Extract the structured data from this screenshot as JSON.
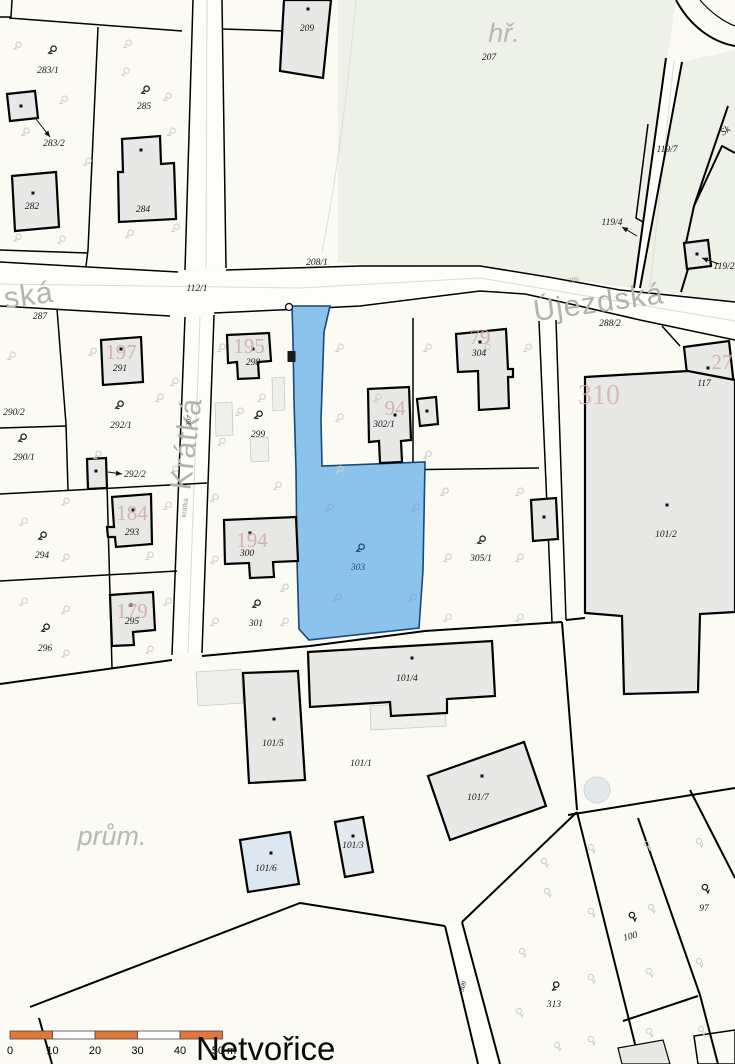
{
  "title": "Netvořice",
  "title_pos": [
    196,
    1060
  ],
  "colors": {
    "paper": "#fbfbf4",
    "field_green": "#edf1e6",
    "water_blue": "#8cc3ec",
    "water_border": "#17497c",
    "building_fill": "#e8e8e6",
    "building_number_pink": "#d2a7a7",
    "street_gray": "#b3b3ae",
    "scale_orange": "#e2763b"
  },
  "map": {
    "labels": [
      {
        "text": "283/1",
        "x": 48,
        "y": 73,
        "cls": "p",
        "name": "parcel-label-283-1"
      },
      {
        "text": "285",
        "x": 144,
        "y": 109,
        "cls": "p",
        "name": "parcel-label-285"
      },
      {
        "text": "283/2",
        "x": 54,
        "y": 146,
        "cls": "p",
        "name": "parcel-label-283-2"
      },
      {
        "text": "282",
        "x": 32,
        "y": 209,
        "cls": "p",
        "name": "parcel-label-282"
      },
      {
        "text": "284",
        "x": 143,
        "y": 212,
        "cls": "p",
        "name": "parcel-label-284"
      },
      {
        "text": "209",
        "x": 307,
        "y": 31,
        "cls": "p",
        "name": "parcel-label-209"
      },
      {
        "text": "hř.",
        "x": 504,
        "y": 42,
        "cls": "area",
        "name": "area-label-hriste"
      },
      {
        "text": "207",
        "x": 489,
        "y": 60,
        "cls": "p",
        "name": "parcel-label-207"
      },
      {
        "text": "119/7",
        "x": 667,
        "y": 152,
        "cls": "p",
        "name": "parcel-label-119-7"
      },
      {
        "text": "Sk",
        "x": 727,
        "y": 133,
        "cls": "sk",
        "rot": -35,
        "name": "label-sk"
      },
      {
        "text": "119/4",
        "x": 612,
        "y": 225,
        "cls": "p",
        "name": "parcel-label-119-4"
      },
      {
        "text": "119/2",
        "x": 724,
        "y": 269,
        "cls": "p",
        "name": "parcel-label-119-2"
      },
      {
        "text": "208/1",
        "x": 317,
        "y": 265,
        "cls": "p",
        "name": "parcel-label-208-1"
      },
      {
        "text": "112/1",
        "x": 197,
        "y": 291,
        "cls": "p",
        "name": "parcel-label-112-1"
      },
      {
        "text": "ská",
        "x": 30,
        "y": 305,
        "cls": "street",
        "rot": -8,
        "name": "street-label-ska"
      },
      {
        "text": "287",
        "x": 40,
        "y": 319,
        "cls": "p",
        "name": "parcel-label-287"
      },
      {
        "text": "Újezdská",
        "x": 600,
        "y": 312,
        "cls": "street",
        "rot": -8,
        "name": "street-label-ujezdska"
      },
      {
        "text": "288/2",
        "x": 610,
        "y": 326,
        "cls": "p",
        "name": "parcel-label-288-2"
      },
      {
        "text": "288",
        "x": 574,
        "y": 282,
        "cls": "pink-tiny",
        "rot": -12,
        "name": "parcel-label-288"
      },
      {
        "text": "197",
        "x": 121,
        "y": 359,
        "cls": "bnum",
        "name": "building-number-197"
      },
      {
        "text": "291",
        "x": 120,
        "y": 371,
        "cls": "p",
        "name": "parcel-label-291"
      },
      {
        "text": "292/1",
        "x": 121,
        "y": 428,
        "cls": "p",
        "name": "parcel-label-292-1"
      },
      {
        "text": "290/2",
        "x": 14,
        "y": 415,
        "cls": "p",
        "name": "parcel-label-290-2"
      },
      {
        "text": "290/1",
        "x": 24,
        "y": 460,
        "cls": "p",
        "name": "parcel-label-290-1"
      },
      {
        "text": "292/2",
        "x": 135,
        "y": 477,
        "cls": "p",
        "name": "parcel-label-292-2"
      },
      {
        "text": "Krátká",
        "x": 196,
        "y": 445,
        "cls": "street",
        "rot": -83,
        "name": "street-label-kratka"
      },
      {
        "text": "307",
        "x": 191,
        "y": 421,
        "cls": "tiny",
        "rot": -82,
        "name": "parcel-label-307"
      },
      {
        "text": "krátká",
        "x": 187,
        "y": 508,
        "cls": "streettiny",
        "rot": -82,
        "name": "street-label-kratka-small"
      },
      {
        "text": "195",
        "x": 249,
        "y": 353,
        "cls": "bnum",
        "name": "building-number-195"
      },
      {
        "text": "298",
        "x": 253,
        "y": 365,
        "cls": "p",
        "name": "parcel-label-298"
      },
      {
        "text": "299",
        "x": 258,
        "y": 437,
        "cls": "p",
        "name": "parcel-label-299"
      },
      {
        "text": "303",
        "x": 358,
        "y": 570,
        "cls": "blue",
        "name": "parcel-label-303"
      },
      {
        "text": "94",
        "x": 395,
        "y": 415,
        "cls": "bnum",
        "name": "building-number-94"
      },
      {
        "text": "302/1",
        "x": 384,
        "y": 427,
        "cls": "p",
        "name": "parcel-label-302-1"
      },
      {
        "text": "79",
        "x": 480,
        "y": 344,
        "cls": "bnum",
        "name": "building-number-79"
      },
      {
        "text": "304",
        "x": 479,
        "y": 356,
        "cls": "p",
        "name": "parcel-label-304"
      },
      {
        "text": "310",
        "x": 599,
        "y": 404,
        "cls": "bnumlg",
        "name": "building-number-310"
      },
      {
        "text": "27",
        "x": 722,
        "y": 369,
        "cls": "bnum",
        "name": "building-number-27"
      },
      {
        "text": "117",
        "x": 704,
        "y": 386,
        "cls": "p",
        "name": "parcel-label-117"
      },
      {
        "text": "101/2",
        "x": 666,
        "y": 537,
        "cls": "p",
        "name": "parcel-label-101-2"
      },
      {
        "text": "194",
        "x": 252,
        "y": 547,
        "cls": "bnum",
        "name": "building-number-194"
      },
      {
        "text": "300",
        "x": 247,
        "y": 556,
        "cls": "p",
        "name": "parcel-label-300"
      },
      {
        "text": "301",
        "x": 256,
        "y": 626,
        "cls": "p",
        "name": "parcel-label-301"
      },
      {
        "text": "305/1",
        "x": 481,
        "y": 561,
        "cls": "p",
        "name": "parcel-label-305-1"
      },
      {
        "text": "184",
        "x": 132,
        "y": 520,
        "cls": "bnum",
        "name": "building-number-184"
      },
      {
        "text": "293",
        "x": 132,
        "y": 535,
        "cls": "p",
        "name": "parcel-label-293"
      },
      {
        "text": "294",
        "x": 42,
        "y": 558,
        "cls": "p",
        "name": "parcel-label-294"
      },
      {
        "text": "179",
        "x": 132,
        "y": 618,
        "cls": "bnum",
        "name": "building-number-179"
      },
      {
        "text": "295",
        "x": 132,
        "y": 624,
        "cls": "p",
        "name": "parcel-label-295"
      },
      {
        "text": "296",
        "x": 45,
        "y": 651,
        "cls": "p",
        "name": "parcel-label-296"
      },
      {
        "text": "101/4",
        "x": 407,
        "y": 681,
        "cls": "p",
        "name": "parcel-label-101-4"
      },
      {
        "text": "101/5",
        "x": 273,
        "y": 746,
        "cls": "p",
        "name": "parcel-label-101-5"
      },
      {
        "text": "101/1",
        "x": 361,
        "y": 766,
        "cls": "p",
        "name": "parcel-label-101-1"
      },
      {
        "text": "101/7",
        "x": 478,
        "y": 800,
        "cls": "p",
        "name": "parcel-label-101-7"
      },
      {
        "text": "prům.",
        "x": 112,
        "y": 845,
        "cls": "area",
        "name": "area-label-prumysl"
      },
      {
        "text": "101/6",
        "x": 266,
        "y": 871,
        "cls": "p",
        "name": "parcel-label-101-6"
      },
      {
        "text": "101/3",
        "x": 353,
        "y": 848,
        "cls": "p",
        "name": "parcel-label-101-3"
      },
      {
        "text": "313",
        "x": 554,
        "y": 1007,
        "cls": "p",
        "name": "parcel-label-313"
      },
      {
        "text": "100",
        "x": 631,
        "y": 939,
        "cls": "p",
        "rot": -15,
        "name": "parcel-label-100"
      },
      {
        "text": "97",
        "x": 704,
        "y": 911,
        "cls": "p",
        "name": "parcel-label-97"
      },
      {
        "text": "309",
        "x": 465,
        "y": 987,
        "cls": "tiny",
        "rot": -72,
        "name": "parcel-label-309"
      }
    ],
    "tree_symbols": [
      {
        "x": 53,
        "y": 50,
        "cls": "b"
      },
      {
        "x": 146,
        "y": 90,
        "cls": "b"
      },
      {
        "x": 120,
        "y": 405,
        "cls": "b"
      },
      {
        "x": 23,
        "y": 438,
        "cls": "b"
      },
      {
        "x": 259,
        "y": 415,
        "cls": "b"
      },
      {
        "x": 43,
        "y": 536,
        "cls": "b"
      },
      {
        "x": 46,
        "y": 628,
        "cls": "b"
      },
      {
        "x": 257,
        "y": 604,
        "cls": "b"
      },
      {
        "x": 482,
        "y": 540,
        "cls": "b"
      },
      {
        "x": 556,
        "y": 986,
        "rot": -15,
        "cls": "b"
      },
      {
        "x": 633,
        "y": 916,
        "rot": -75,
        "cls": "b"
      },
      {
        "x": 706,
        "y": 888,
        "rot": -75,
        "cls": "b"
      },
      {
        "x": 361,
        "y": 548,
        "cls": "blueb"
      },
      {
        "x": 330,
        "y": 508,
        "cls": "bluef"
      },
      {
        "x": 416,
        "y": 508,
        "cls": "bluef"
      },
      {
        "x": 338,
        "y": 598,
        "cls": "bluef"
      },
      {
        "x": 413,
        "y": 598,
        "cls": "bluef"
      },
      {
        "x": 18,
        "y": 46,
        "cls": "faint"
      },
      {
        "x": 64,
        "y": 100,
        "cls": "faint"
      },
      {
        "x": 126,
        "y": 72,
        "cls": "faint"
      },
      {
        "x": 26,
        "y": 132,
        "cls": "faint"
      },
      {
        "x": 88,
        "y": 162,
        "cls": "faint"
      },
      {
        "x": 168,
        "y": 97,
        "cls": "faint"
      },
      {
        "x": 128,
        "y": 44,
        "cls": "faint"
      },
      {
        "x": 172,
        "y": 132,
        "cls": "faint"
      },
      {
        "x": 18,
        "y": 238,
        "cls": "faint"
      },
      {
        "x": 62,
        "y": 240,
        "cls": "faint"
      },
      {
        "x": 130,
        "y": 234,
        "cls": "faint"
      },
      {
        "x": 176,
        "y": 228,
        "cls": "faint"
      },
      {
        "x": 93,
        "y": 352,
        "cls": "faint"
      },
      {
        "x": 160,
        "y": 398,
        "cls": "faint"
      },
      {
        "x": 98,
        "y": 455,
        "cls": "faint"
      },
      {
        "x": 175,
        "y": 382,
        "cls": "faint"
      },
      {
        "x": 175,
        "y": 470,
        "cls": "faint"
      },
      {
        "x": 12,
        "y": 356,
        "cls": "faint"
      },
      {
        "x": 222,
        "y": 348,
        "cls": "faint"
      },
      {
        "x": 262,
        "y": 398,
        "cls": "faint"
      },
      {
        "x": 222,
        "y": 442,
        "cls": "faint"
      },
      {
        "x": 278,
        "y": 486,
        "cls": "faint"
      },
      {
        "x": 240,
        "y": 412,
        "cls": "faint"
      },
      {
        "x": 340,
        "y": 348,
        "cls": "faint"
      },
      {
        "x": 428,
        "y": 348,
        "cls": "faint"
      },
      {
        "x": 487,
        "y": 348,
        "cls": "faint"
      },
      {
        "x": 528,
        "y": 348,
        "cls": "faint"
      },
      {
        "x": 340,
        "y": 418,
        "cls": "faint"
      },
      {
        "x": 378,
        "y": 398,
        "cls": "faint"
      },
      {
        "x": 428,
        "y": 455,
        "cls": "faint"
      },
      {
        "x": 340,
        "y": 470,
        "cls": "faint"
      },
      {
        "x": 445,
        "y": 492,
        "cls": "faint"
      },
      {
        "x": 520,
        "y": 492,
        "cls": "faint"
      },
      {
        "x": 448,
        "y": 558,
        "cls": "faint"
      },
      {
        "x": 520,
        "y": 558,
        "cls": "faint"
      },
      {
        "x": 448,
        "y": 618,
        "cls": "faint"
      },
      {
        "x": 520,
        "y": 618,
        "cls": "faint"
      },
      {
        "x": 66,
        "y": 502,
        "cls": "faint"
      },
      {
        "x": 24,
        "y": 522,
        "cls": "faint"
      },
      {
        "x": 168,
        "y": 506,
        "cls": "faint"
      },
      {
        "x": 66,
        "y": 558,
        "cls": "faint"
      },
      {
        "x": 150,
        "y": 556,
        "cls": "faint"
      },
      {
        "x": 66,
        "y": 610,
        "cls": "faint"
      },
      {
        "x": 24,
        "y": 602,
        "cls": "faint"
      },
      {
        "x": 168,
        "y": 602,
        "cls": "faint"
      },
      {
        "x": 66,
        "y": 654,
        "cls": "faint"
      },
      {
        "x": 150,
        "y": 650,
        "cls": "faint"
      },
      {
        "x": 215,
        "y": 498,
        "cls": "faint"
      },
      {
        "x": 215,
        "y": 560,
        "cls": "faint"
      },
      {
        "x": 285,
        "y": 588,
        "cls": "faint"
      },
      {
        "x": 215,
        "y": 622,
        "cls": "faint"
      },
      {
        "x": 285,
        "y": 622,
        "cls": "faint"
      },
      {
        "x": 592,
        "y": 848,
        "rot": -75,
        "cls": "faint"
      },
      {
        "x": 648,
        "y": 845,
        "rot": -75,
        "cls": "faint"
      },
      {
        "x": 700,
        "y": 842,
        "rot": -75,
        "cls": "faint"
      },
      {
        "x": 592,
        "y": 912,
        "rot": -75,
        "cls": "faint"
      },
      {
        "x": 652,
        "y": 908,
        "rot": -75,
        "cls": "faint"
      },
      {
        "x": 700,
        "y": 962,
        "rot": -75,
        "cls": "faint"
      },
      {
        "x": 592,
        "y": 978,
        "rot": -75,
        "cls": "faint"
      },
      {
        "x": 650,
        "y": 972,
        "rot": -75,
        "cls": "faint"
      },
      {
        "x": 523,
        "y": 952,
        "rot": -75,
        "cls": "faint"
      },
      {
        "x": 548,
        "y": 892,
        "rot": -75,
        "cls": "faint"
      },
      {
        "x": 592,
        "y": 1040,
        "rot": -75,
        "cls": "faint"
      },
      {
        "x": 650,
        "y": 1032,
        "rot": -75,
        "cls": "faint"
      },
      {
        "x": 702,
        "y": 1030,
        "rot": -75,
        "cls": "faint"
      },
      {
        "x": 520,
        "y": 1012,
        "rot": -75,
        "cls": "faint"
      },
      {
        "x": 558,
        "y": 1046,
        "rot": -75,
        "cls": "faint"
      },
      {
        "x": 545,
        "y": 862,
        "rot": -75,
        "cls": "faint"
      }
    ],
    "building_dots": [
      [
        21,
        106
      ],
      [
        308,
        9
      ],
      [
        141,
        150
      ],
      [
        33,
        193
      ],
      [
        697,
        254
      ],
      [
        121,
        349
      ],
      [
        96,
        471
      ],
      [
        253,
        349
      ],
      [
        395,
        415
      ],
      [
        427,
        411
      ],
      [
        480,
        342
      ],
      [
        708,
        368
      ],
      [
        667,
        505
      ],
      [
        544,
        517
      ],
      [
        250,
        533
      ],
      [
        133,
        510
      ],
      [
        131,
        605
      ],
      [
        412,
        658
      ],
      [
        274,
        719
      ],
      [
        482,
        776
      ],
      [
        271,
        853
      ],
      [
        353,
        836
      ]
    ],
    "arrows": [
      {
        "from": [
          36,
          119
        ],
        "to": [
          50,
          137
        ]
      },
      {
        "from": [
          108,
          472
        ],
        "to": [
          122,
          474
        ]
      },
      {
        "from": [
          637,
          236
        ],
        "to": [
          622,
          227
        ]
      },
      {
        "from": [
          719,
          264
        ],
        "to": [
          702,
          258
        ]
      }
    ]
  },
  "scale_bar": {
    "x": 10,
    "y": 1031,
    "seg_w": 42.5,
    "h": 8,
    "label_y": 1054,
    "segments": [
      "orange",
      "white",
      "orange",
      "white",
      "orange"
    ],
    "labels": [
      {
        "text": "0",
        "x": 10
      },
      {
        "text": "10",
        "x": 52.5
      },
      {
        "text": "20",
        "x": 95
      },
      {
        "text": "30",
        "x": 137.5
      },
      {
        "text": "40",
        "x": 180
      },
      {
        "text": "50 m",
        "x": 224
      }
    ]
  }
}
